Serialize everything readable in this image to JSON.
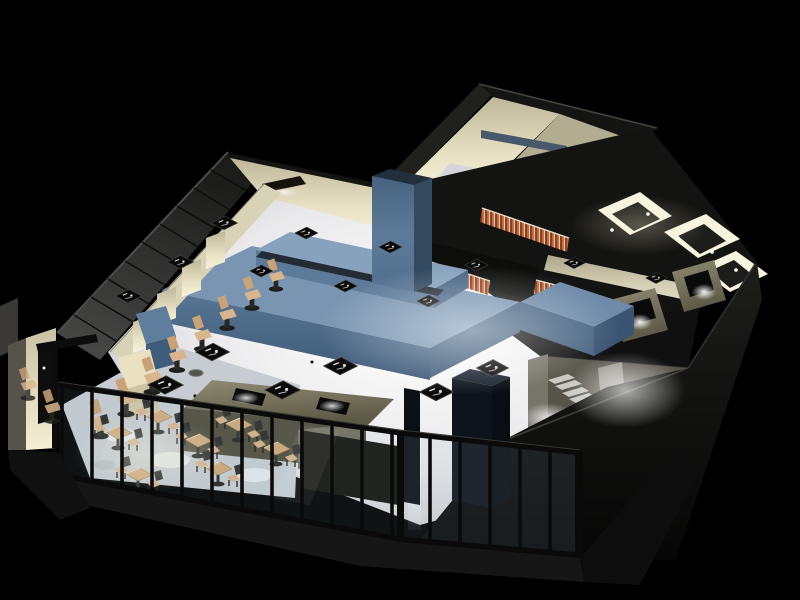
{
  "meta": {
    "kind": "3d-architectural-render",
    "subject": "Isometric night cutaway rendering of a restaurant / bar interior floor plan",
    "has_text": false,
    "view": "cutaway axonometric from south-east, walls sliced at counter height, dark exterior"
  },
  "colors": {
    "bg": "#000000",
    "panel_wall_dark": "#1f1f1d",
    "panel_wall_light": "#4a4a48",
    "panel_seam": "#0e0e0c",
    "cream_bright": "#f4eed4",
    "cream_mid": "#ddd6b8",
    "cream_dim": "#b2ac90",
    "wall_cut_dark": "#141412",
    "slab_dark": "#131311",
    "dark_mass": "#0b0b0a",
    "edge_highlight": "#45453e",
    "bar_top": "#7a95b1",
    "bar_front": "#506d8c",
    "bar_side": "#46627f",
    "bar_dark": "#3a5472",
    "bar_ridge_top": "#86a2bd",
    "counter_dark": "#232b34",
    "column_blue": "#5d7b99",
    "column_side": "#33495f",
    "floor_white": "#ffffff",
    "floor_edge": "#c6c8cc",
    "dining_floor": "#c6ccd1",
    "floor_mottle": "#eef2f4",
    "glass_tint": "#9fb6c2",
    "mullion": "#0a0a0a",
    "khaki_top": "#837f68",
    "khaki_front": "#4f4c3c",
    "khaki_light": "#a19d86",
    "tile_red": "#8e3e1e",
    "tile_orange": "#c4673a",
    "tile_cream": "#d9cdb6",
    "wood": "#cfa97a",
    "wood_dark": "#9a7b52",
    "stool_wood": "#d9b58d",
    "stool_back": "#c9a277",
    "chair_dark": "#2a2a28",
    "table_black": "#0a0a0a",
    "table_edge": "#46463e",
    "glyph_white": "#e8e8e6",
    "stair_light": "#c9c9c2",
    "stair_dark": "#55554f",
    "stair_wall": "#77756a",
    "gray_box": "#d6d6da",
    "shelf_blue": "#47586b",
    "vest_cream": "#d8d1b4",
    "vest_gray": "#55534a",
    "door_black": "#0e0e0e",
    "navy_col": "#0e131c",
    "room_glow": "#f7f3dd",
    "room_floor": "#1c1c1a",
    "glow_white": "#ffffff",
    "glow_warm": "#fff3d0"
  },
  "inventory": {
    "bar_stools": 10,
    "dining_table_sets": 7,
    "black_square_tables_on_floor": 6,
    "place_setting_trays_on_bar": 6,
    "menu_boards_on_ledge": 3,
    "restroom_cells": 3,
    "tiled_wainscot_bands": 3,
    "facade_mullions": 17,
    "staircase_steps": 7,
    "recessed_downlights": 4,
    "wall_lamps": 1,
    "dark_structural_columns": 2
  },
  "icons": {
    "place-setting-glyph": "tiny white strokes and dot on each dark square table",
    "recessed-light-glyph": "white glow dot inside dark ceiling recess"
  }
}
